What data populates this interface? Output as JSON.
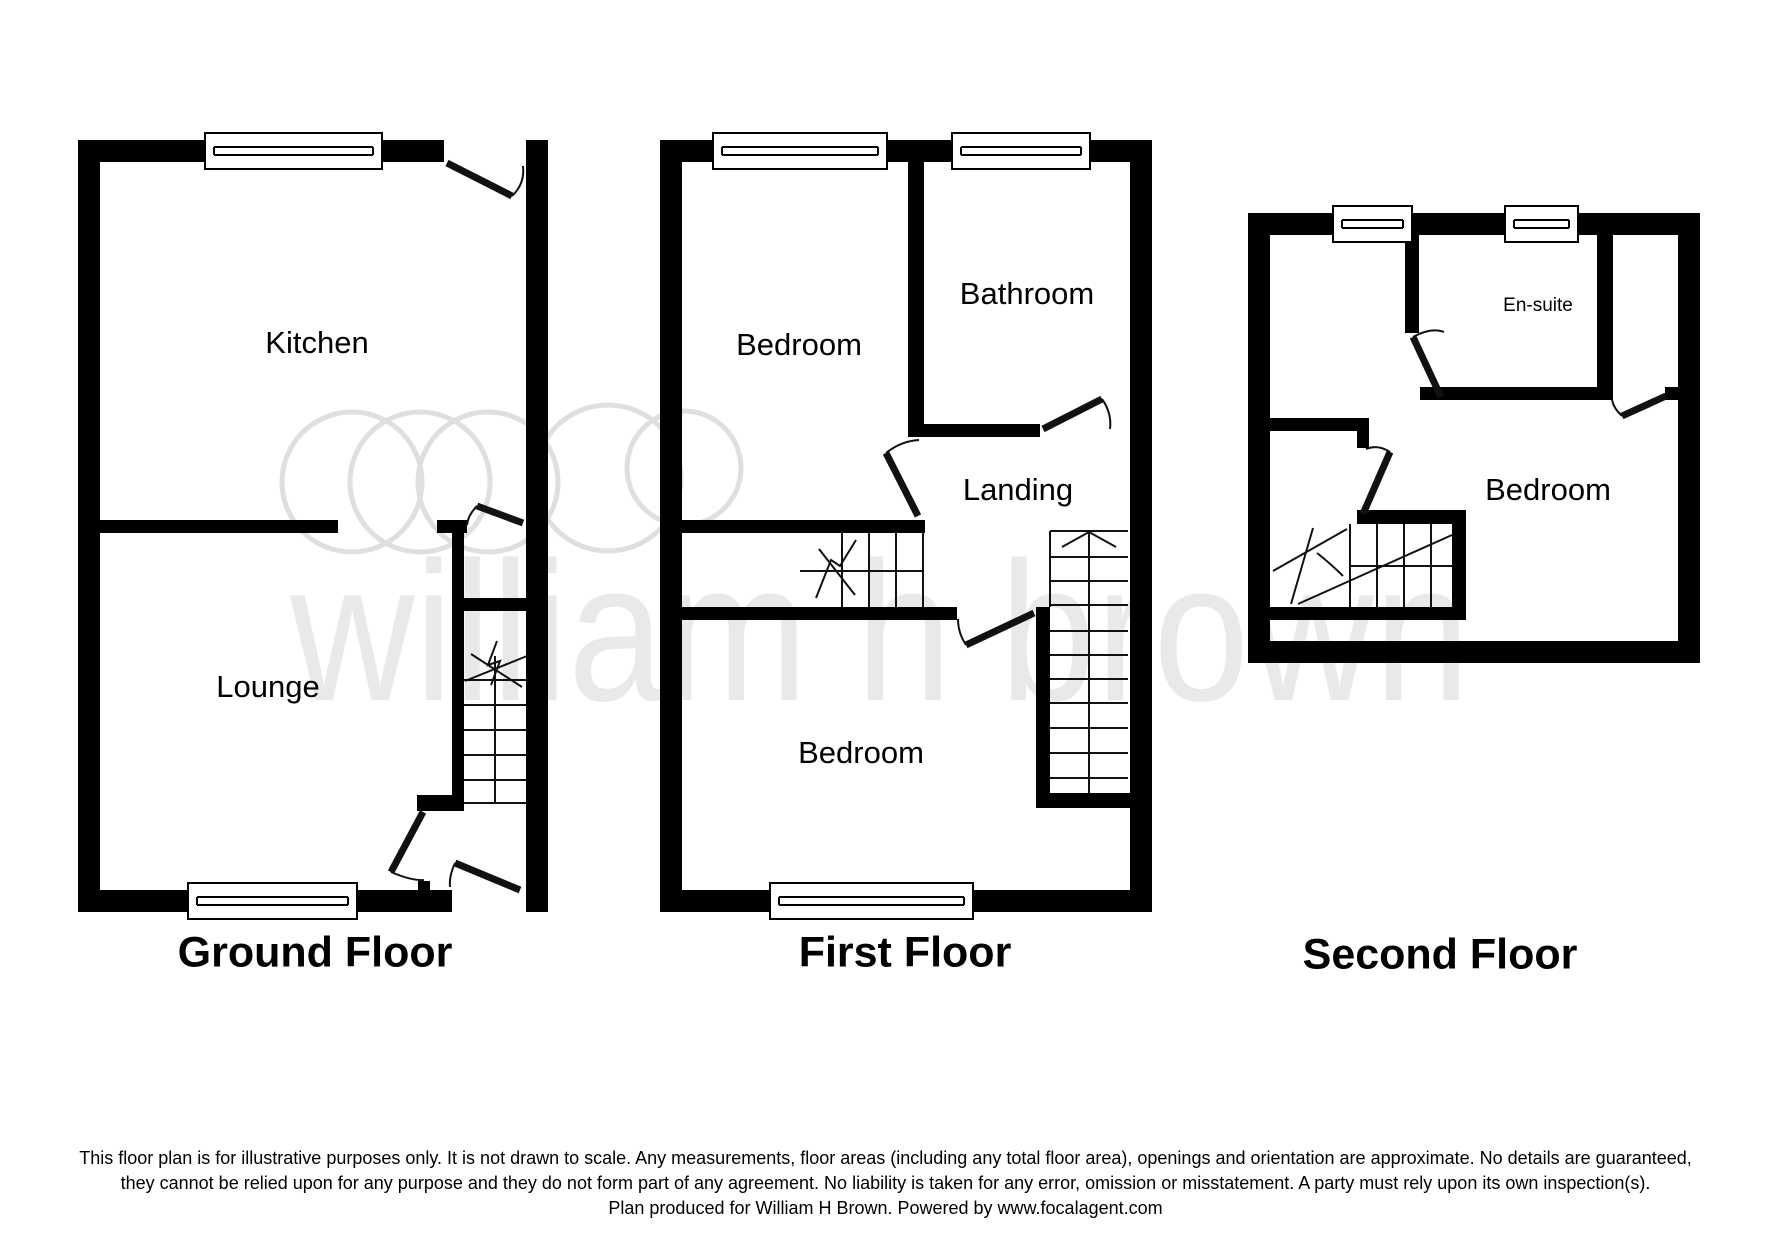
{
  "watermark": {
    "text": "william h brown"
  },
  "floors": [
    {
      "title": "Ground Floor",
      "rooms": [
        {
          "name": "Kitchen"
        },
        {
          "name": "Lounge"
        }
      ]
    },
    {
      "title": "First Floor",
      "rooms": [
        {
          "name": "Bedroom"
        },
        {
          "name": "Bathroom"
        },
        {
          "name": "Landing"
        },
        {
          "name": "Bedroom"
        }
      ]
    },
    {
      "title": "Second Floor",
      "rooms": [
        {
          "name": "En-suite"
        },
        {
          "name": "Bedroom"
        }
      ]
    }
  ],
  "disclaimer": {
    "line1": "This floor plan is for illustrative purposes only. It is not drawn to scale. Any measurements, floor areas (including any total floor area), openings and orientation are approximate. No details are guaranteed,",
    "line2": "they cannot be relied upon for any purpose and they do not form part of any agreement. No liability is taken for any error, omission or misstatement. A party must rely upon its own inspection(s).",
    "line3": "Plan produced for William H Brown. Powered by www.focalagent.com"
  },
  "colors": {
    "wall": "#000000",
    "label": "#000000",
    "watermark_ring": "#dfdfdf",
    "watermark_text": "#e9e9e9"
  }
}
